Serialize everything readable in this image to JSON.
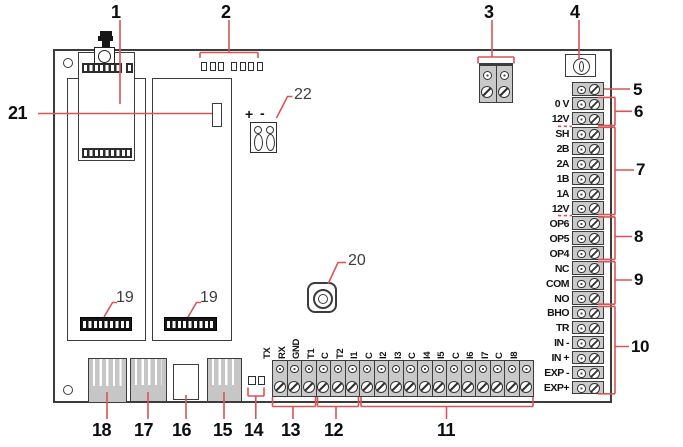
{
  "figure": {
    "description_kind": "alarm-panel-pcb-diagram"
  },
  "callouts": {
    "n1": "1",
    "n2": "2",
    "n3": "3",
    "n4": "4",
    "n5": "5",
    "n6": "6",
    "n7": "7",
    "n8": "8",
    "n9": "9",
    "n10": "10",
    "n11": "11",
    "n12": "12",
    "n13": "13",
    "n14": "14",
    "n15": "15",
    "n16": "16",
    "n17": "17",
    "n18": "18",
    "n19": "19",
    "n20": "20",
    "n21": "21",
    "n22": "22"
  },
  "right_terminals": {
    "labels": [
      "",
      "0 V",
      "12V",
      "SH",
      "2B",
      "2A",
      "1B",
      "1A",
      "12V",
      "OP6",
      "OP5",
      "OP4",
      "NC",
      "COM",
      "NO",
      "BHO",
      "TR",
      "IN -",
      "IN +",
      "EXP -",
      "EXP+"
    ]
  },
  "bottom_terminals": {
    "labels": [
      "TX",
      "RX",
      "GND",
      "T1",
      "C",
      "T2",
      "I1",
      "C",
      "I2",
      "I3",
      "C",
      "I4",
      "I5",
      "C",
      "I6",
      "I7",
      "C",
      "I8"
    ]
  },
  "connector_22": {
    "plus_label": "+",
    "minus_label": "-"
  },
  "colors": {
    "callout_red": "#d85555",
    "terminal_gray": "#c9c9c9",
    "line_dark": "#3c3c3c"
  }
}
